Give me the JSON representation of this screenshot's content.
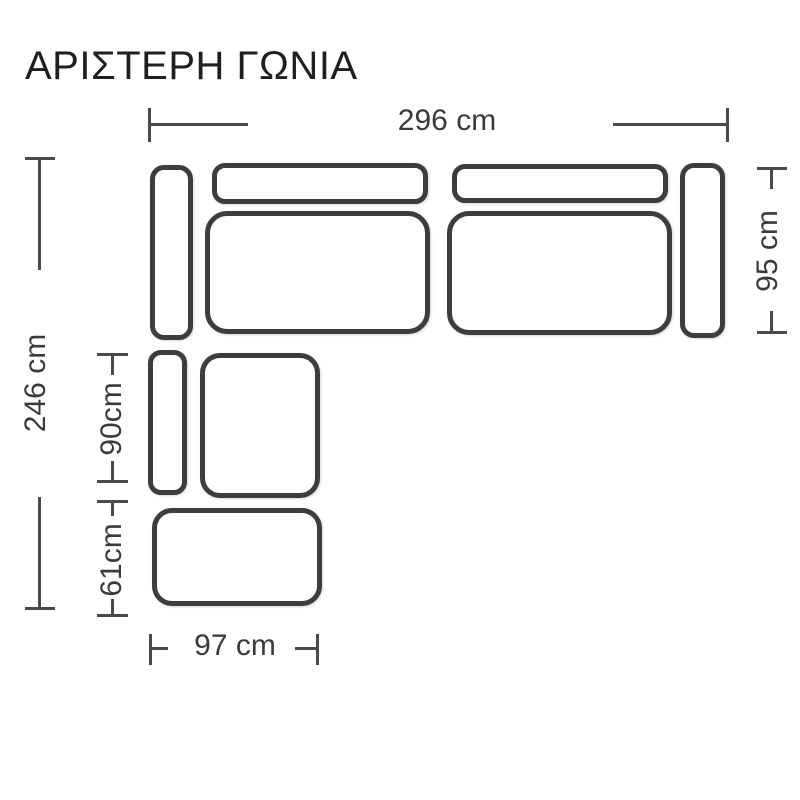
{
  "title": "ΑΡΙΣΤΕΡΗ ΓΩΝΙΑ",
  "diagram_type": "corner-sofa-floorplan",
  "colors": {
    "outline": "#3d3d3d",
    "dim": "#4a4a4a",
    "text-dim": "#3a3a3a",
    "title": "#1f1f1f",
    "bg": "#ffffff"
  },
  "sofa": {
    "pieces": [
      "left-armrest",
      "left-backrest",
      "left-seat",
      "right-backrest",
      "right-seat",
      "right-armrest",
      "corner-armrest",
      "corner-seat",
      "ottoman"
    ]
  },
  "dimensions": {
    "top_width": "296 cm",
    "right_depth": "95 cm",
    "left_depth": "246 cm",
    "corner_section_depth": "90cm",
    "ottoman_depth": "61cm",
    "bottom_width": "97 cm"
  }
}
